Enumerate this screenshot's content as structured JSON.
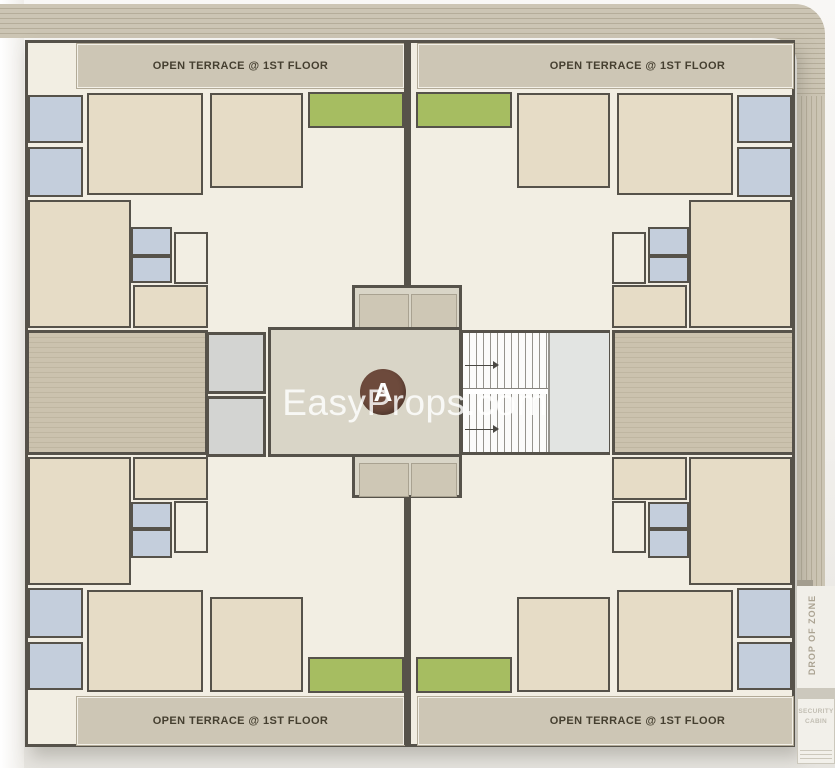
{
  "plan": {
    "title_block": "A",
    "watermark": "EasyProps.com",
    "terrace_label": "OPEN TERRACE @ 1ST FLOOR",
    "terrace_labels": [
      "OPEN TERRACE @ 1ST FLOOR",
      "OPEN TERRACE @ 1ST FLOOR",
      "OPEN TERRACE @ 1ST FLOOR",
      "OPEN TERRACE @ 1ST FLOOR"
    ],
    "side_labels": {
      "drop_zone": "DROP OF ZONE",
      "security_cabin": "SECURITY\nCABIN"
    },
    "rooms_legend": {
      "bedroom_kitchen": "beige",
      "toilet_bath": "blue",
      "living_dining": "off-white",
      "balcony": "green",
      "open_terrace": "tan band",
      "deck_sitout": "striped tan",
      "lift": "gray",
      "stair": "white with treads",
      "lobby": "khaki"
    },
    "colors": {
      "wall": "#56524a",
      "room_offwhite": "#f2eee3",
      "room_beige": "#e6dcc6",
      "room_blue": "#c4cedc",
      "balcony_green": "#a6bd61",
      "terrace_band": "#cdc6b5",
      "deck": "#c5bca8",
      "core_lobby": "#d9d5c7",
      "lift_gray": "#d3d4d2",
      "stair_landing": "#e2e4e2",
      "block_circle_brown": "#6d4a3c",
      "compound_band": "#c2bbaa"
    }
  }
}
